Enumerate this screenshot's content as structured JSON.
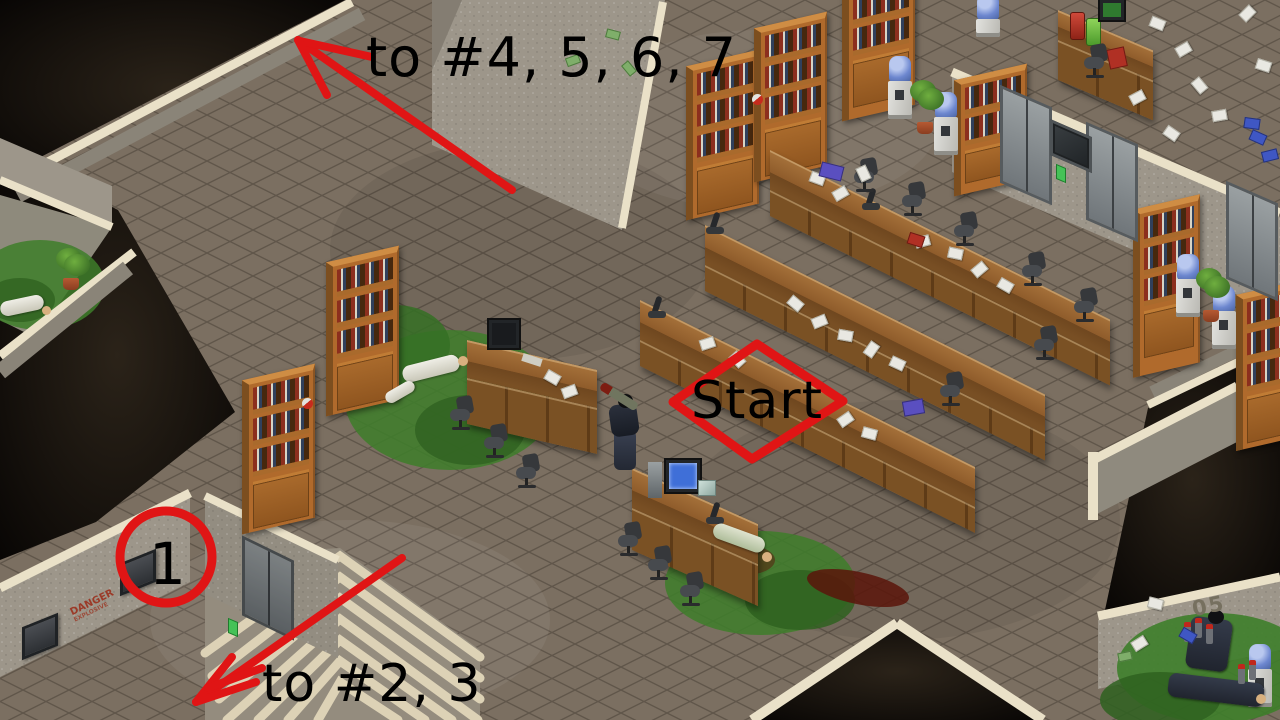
{
  "annotations": {
    "route_up": "to #4, 5, 6, 7",
    "route_down": "to #2, 3",
    "start": "Start",
    "marker_1": "1"
  },
  "wall_markings": {
    "danger_top": "DANGER",
    "danger_bottom": "EXPLOSIVE",
    "sector": "05"
  },
  "colors": {
    "annotation": "#e01515",
    "ink": "#000000",
    "floor": "#7b6f61",
    "void": "#17110c",
    "wall": "#9d968a",
    "trim": "#eae1c8",
    "wood": "#b06a2c",
    "slime": "#3e7e2a",
    "blood": "#5a150a",
    "water_bottle": "#6d87cf"
  },
  "scene": {
    "objects": [
      {
        "name": "player-character",
        "count": 1
      },
      {
        "name": "dead-scientist",
        "count": 3
      },
      {
        "name": "dead-soldier",
        "count": 2
      },
      {
        "name": "bookshelf",
        "count": 8
      },
      {
        "name": "long-office-desk",
        "count": 3
      },
      {
        "name": "computer-desk",
        "count": 2
      },
      {
        "name": "lab-desk",
        "count": 1
      },
      {
        "name": "office-chair",
        "count": 14
      },
      {
        "name": "water-cooler",
        "count": 6
      },
      {
        "name": "potted-plant",
        "count": 3
      },
      {
        "name": "microscope",
        "count": 4
      },
      {
        "name": "elevator-door",
        "count": 4
      },
      {
        "name": "wall-vent",
        "count": 2
      },
      {
        "name": "staircase",
        "count": 1
      },
      {
        "name": "scattered-papers",
        "count": 1
      },
      {
        "name": "money-bills",
        "count": 1
      },
      {
        "name": "slime-patch",
        "count": 4
      }
    ]
  }
}
